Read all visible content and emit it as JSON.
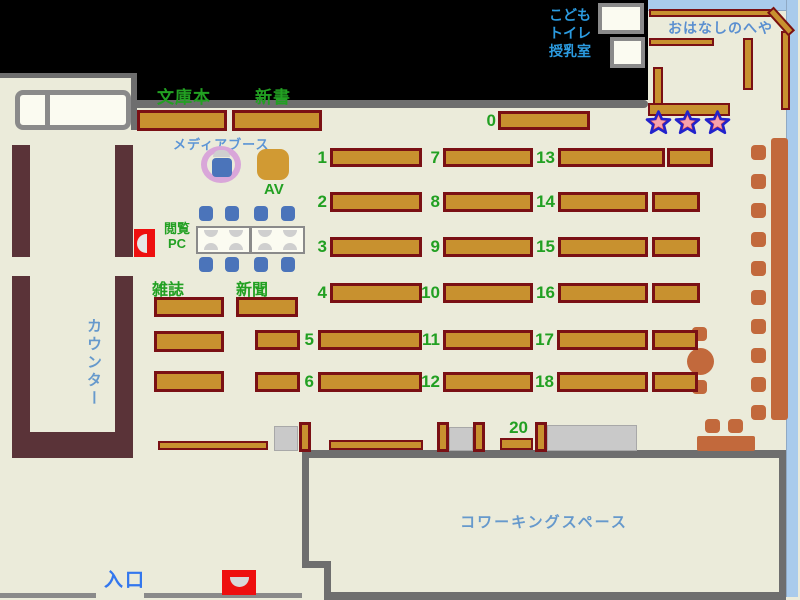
{
  "title": "library-floor-map",
  "labels": {
    "paperbacks": "文庫本",
    "new_books": "新書",
    "media_booth": "メディアブース",
    "av": "AV",
    "browsing_pc_line1": "閲覧",
    "browsing_pc_line2": "PC",
    "magazines": "雑誌",
    "newspapers": "新聞",
    "counter": "カウンター",
    "entrance": "入口",
    "coworking_space": "コワーキングスペース",
    "storytime_room": "おはなしのへや",
    "kids": "こども",
    "toilet": "トイレ",
    "nursing_room": "授乳室"
  },
  "shelf_numbers": [
    "0",
    "1",
    "2",
    "3",
    "4",
    "5",
    "6",
    "7",
    "8",
    "9",
    "10",
    "11",
    "12",
    "13",
    "14",
    "15",
    "16",
    "17",
    "18",
    "20"
  ],
  "colors": {
    "floor": "#EBEBDA",
    "black_area": "#000000",
    "wall_gray": "#6E6E6E",
    "shelf_fill": "#C8912F",
    "shelf_border": "#7A1014",
    "counter_maroon": "#5A3338",
    "wood_furniture": "#C2693C",
    "chair_blue": "#4B74BA",
    "gate_red": "#EE0F0F",
    "label_green": "#22A022",
    "label_blue": "#5C95D6",
    "room_border_blue": "#A9CBEC",
    "star_red": "#E04040",
    "star_outline": "#2222CC",
    "media_ring_plum": "#D9A6D9"
  }
}
